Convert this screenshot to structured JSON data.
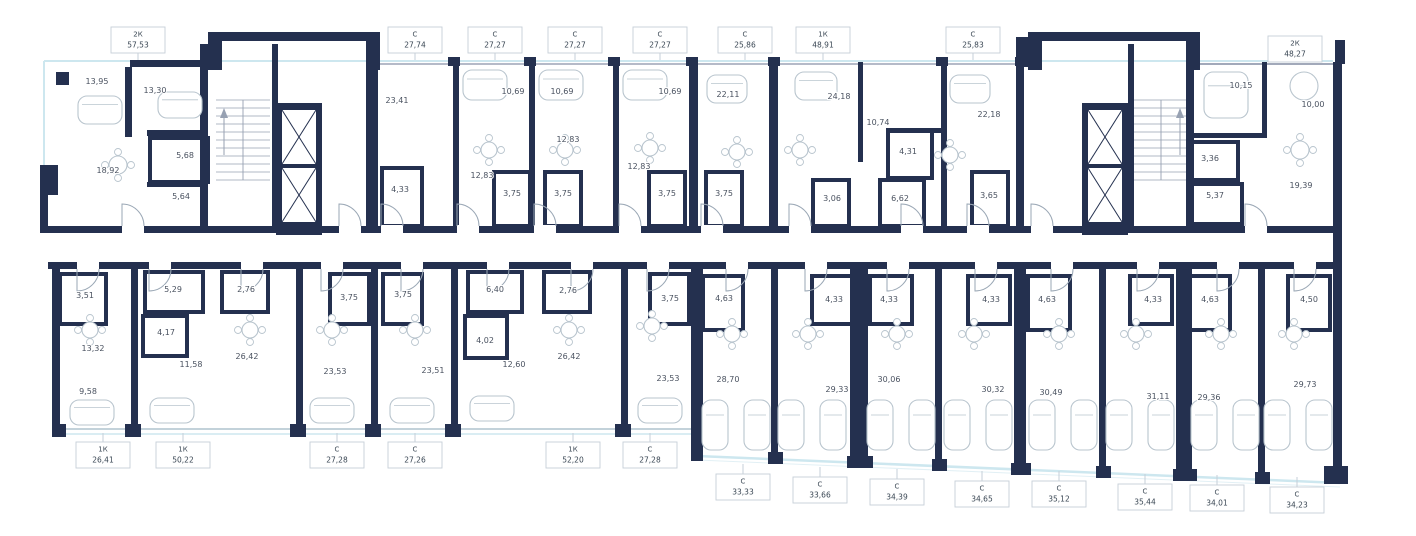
{
  "title": "Floor plan",
  "colors": {
    "wall": "#24304f",
    "glazing": "#cde7ef",
    "glazing_faint": "#e2f0f5",
    "furniture": "#b9c5ce",
    "stair_line": "#97a1b2",
    "door_arc": "#9aa7b5",
    "label_border": "#c6cfd8",
    "label_text": "#3a4754",
    "room_text": "#4a5260"
  },
  "unit_labels": [
    {
      "group": "top",
      "type": "2К",
      "area": "57,53",
      "x": 138,
      "y": 40
    },
    {
      "group": "top",
      "type": "С",
      "area": "27,74",
      "x": 415,
      "y": 40
    },
    {
      "group": "top",
      "type": "С",
      "area": "27,27",
      "x": 495,
      "y": 40
    },
    {
      "group": "top",
      "type": "С",
      "area": "27,27",
      "x": 575,
      "y": 40
    },
    {
      "group": "top",
      "type": "С",
      "area": "27,27",
      "x": 660,
      "y": 40
    },
    {
      "group": "top",
      "type": "С",
      "area": "25,86",
      "x": 745,
      "y": 40
    },
    {
      "group": "top",
      "type": "1К",
      "area": "48,91",
      "x": 823,
      "y": 40
    },
    {
      "group": "top",
      "type": "С",
      "area": "25,83",
      "x": 973,
      "y": 40
    },
    {
      "group": "top",
      "type": "2К",
      "area": "48,27",
      "x": 1295,
      "y": 49
    },
    {
      "group": "bottom_left",
      "type": "1К",
      "area": "26,41",
      "x": 103,
      "y": 455
    },
    {
      "group": "bottom_left",
      "type": "1К",
      "area": "50,22",
      "x": 183,
      "y": 455
    },
    {
      "group": "bottom_left",
      "type": "С",
      "area": "27,28",
      "x": 337,
      "y": 455
    },
    {
      "group": "bottom_left",
      "type": "С",
      "area": "27,26",
      "x": 415,
      "y": 455
    },
    {
      "group": "bottom_left",
      "type": "1К",
      "area": "52,20",
      "x": 573,
      "y": 455
    },
    {
      "group": "bottom_left",
      "type": "С",
      "area": "27,28",
      "x": 650,
      "y": 455
    },
    {
      "group": "bottom_right",
      "type": "С",
      "area": "33,33",
      "x": 743,
      "y": 487
    },
    {
      "group": "bottom_right",
      "type": "С",
      "area": "33,66",
      "x": 820,
      "y": 490
    },
    {
      "group": "bottom_right",
      "type": "С",
      "area": "34,39",
      "x": 897,
      "y": 492
    },
    {
      "group": "bottom_right",
      "type": "С",
      "area": "34,65",
      "x": 982,
      "y": 494
    },
    {
      "group": "bottom_right",
      "type": "С",
      "area": "35,12",
      "x": 1059,
      "y": 494
    },
    {
      "group": "bottom_right",
      "type": "С",
      "area": "35,44",
      "x": 1145,
      "y": 497
    },
    {
      "group": "bottom_right",
      "type": "С",
      "area": "34,01",
      "x": 1217,
      "y": 498
    },
    {
      "group": "bottom_right",
      "type": "С",
      "area": "34,23",
      "x": 1297,
      "y": 500
    }
  ],
  "room_areas": [
    {
      "v": "13,95",
      "x": 97,
      "y": 84
    },
    {
      "v": "13,30",
      "x": 155,
      "y": 93
    },
    {
      "v": "5,68",
      "x": 185,
      "y": 158
    },
    {
      "v": "18,92",
      "x": 108,
      "y": 173
    },
    {
      "v": "5,64",
      "x": 181,
      "y": 199
    },
    {
      "v": "23,41",
      "x": 397,
      "y": 103
    },
    {
      "v": "4,33",
      "x": 400,
      "y": 192
    },
    {
      "v": "10,69",
      "x": 513,
      "y": 94
    },
    {
      "v": "10,69",
      "x": 562,
      "y": 94
    },
    {
      "v": "10,69",
      "x": 670,
      "y": 94
    },
    {
      "v": "12,83",
      "x": 568,
      "y": 142
    },
    {
      "v": "12,83",
      "x": 482,
      "y": 178
    },
    {
      "v": "12,83",
      "x": 639,
      "y": 169
    },
    {
      "v": "3,75",
      "x": 512,
      "y": 196
    },
    {
      "v": "3,75",
      "x": 563,
      "y": 196
    },
    {
      "v": "3,75",
      "x": 667,
      "y": 196
    },
    {
      "v": "3,75",
      "x": 724,
      "y": 196
    },
    {
      "v": "22,11",
      "x": 728,
      "y": 97
    },
    {
      "v": "24,18",
      "x": 839,
      "y": 99
    },
    {
      "v": "10,74",
      "x": 878,
      "y": 125
    },
    {
      "v": "4,31",
      "x": 908,
      "y": 154
    },
    {
      "v": "3,06",
      "x": 832,
      "y": 201
    },
    {
      "v": "6,62",
      "x": 900,
      "y": 201
    },
    {
      "v": "22,18",
      "x": 989,
      "y": 117
    },
    {
      "v": "3,65",
      "x": 989,
      "y": 198
    },
    {
      "v": "10,15",
      "x": 1241,
      "y": 88
    },
    {
      "v": "10,00",
      "x": 1313,
      "y": 107
    },
    {
      "v": "3,36",
      "x": 1210,
      "y": 161
    },
    {
      "v": "5,37",
      "x": 1215,
      "y": 198
    },
    {
      "v": "19,39",
      "x": 1301,
      "y": 188
    },
    {
      "v": "3,51",
      "x": 85,
      "y": 298
    },
    {
      "v": "5,29",
      "x": 173,
      "y": 292
    },
    {
      "v": "2,76",
      "x": 246,
      "y": 292
    },
    {
      "v": "4,17",
      "x": 166,
      "y": 335
    },
    {
      "v": "13,32",
      "x": 93,
      "y": 351
    },
    {
      "v": "11,58",
      "x": 191,
      "y": 367
    },
    {
      "v": "26,42",
      "x": 247,
      "y": 359
    },
    {
      "v": "9,58",
      "x": 88,
      "y": 394
    },
    {
      "v": "3,75",
      "x": 349,
      "y": 300
    },
    {
      "v": "23,53",
      "x": 335,
      "y": 374
    },
    {
      "v": "3,75",
      "x": 403,
      "y": 297
    },
    {
      "v": "23,51",
      "x": 433,
      "y": 373
    },
    {
      "v": "6,40",
      "x": 495,
      "y": 292
    },
    {
      "v": "2,76",
      "x": 568,
      "y": 293
    },
    {
      "v": "4,02",
      "x": 485,
      "y": 343
    },
    {
      "v": "12,60",
      "x": 514,
      "y": 367
    },
    {
      "v": "26,42",
      "x": 569,
      "y": 359
    },
    {
      "v": "3,75",
      "x": 670,
      "y": 301
    },
    {
      "v": "23,53",
      "x": 668,
      "y": 381
    },
    {
      "v": "4,63",
      "x": 724,
      "y": 301
    },
    {
      "v": "28,70",
      "x": 728,
      "y": 382
    },
    {
      "v": "4,33",
      "x": 834,
      "y": 302
    },
    {
      "v": "29,33",
      "x": 837,
      "y": 392
    },
    {
      "v": "4,33",
      "x": 889,
      "y": 302
    },
    {
      "v": "30,06",
      "x": 889,
      "y": 382
    },
    {
      "v": "4,33",
      "x": 991,
      "y": 302
    },
    {
      "v": "30,32",
      "x": 993,
      "y": 392
    },
    {
      "v": "4,63",
      "x": 1047,
      "y": 302
    },
    {
      "v": "30,49",
      "x": 1051,
      "y": 395
    },
    {
      "v": "4,33",
      "x": 1153,
      "y": 302
    },
    {
      "v": "31,11",
      "x": 1158,
      "y": 399
    },
    {
      "v": "4,63",
      "x": 1210,
      "y": 302
    },
    {
      "v": "29,36",
      "x": 1209,
      "y": 400
    },
    {
      "v": "4,50",
      "x": 1309,
      "y": 302
    },
    {
      "v": "29,73",
      "x": 1305,
      "y": 387
    }
  ]
}
